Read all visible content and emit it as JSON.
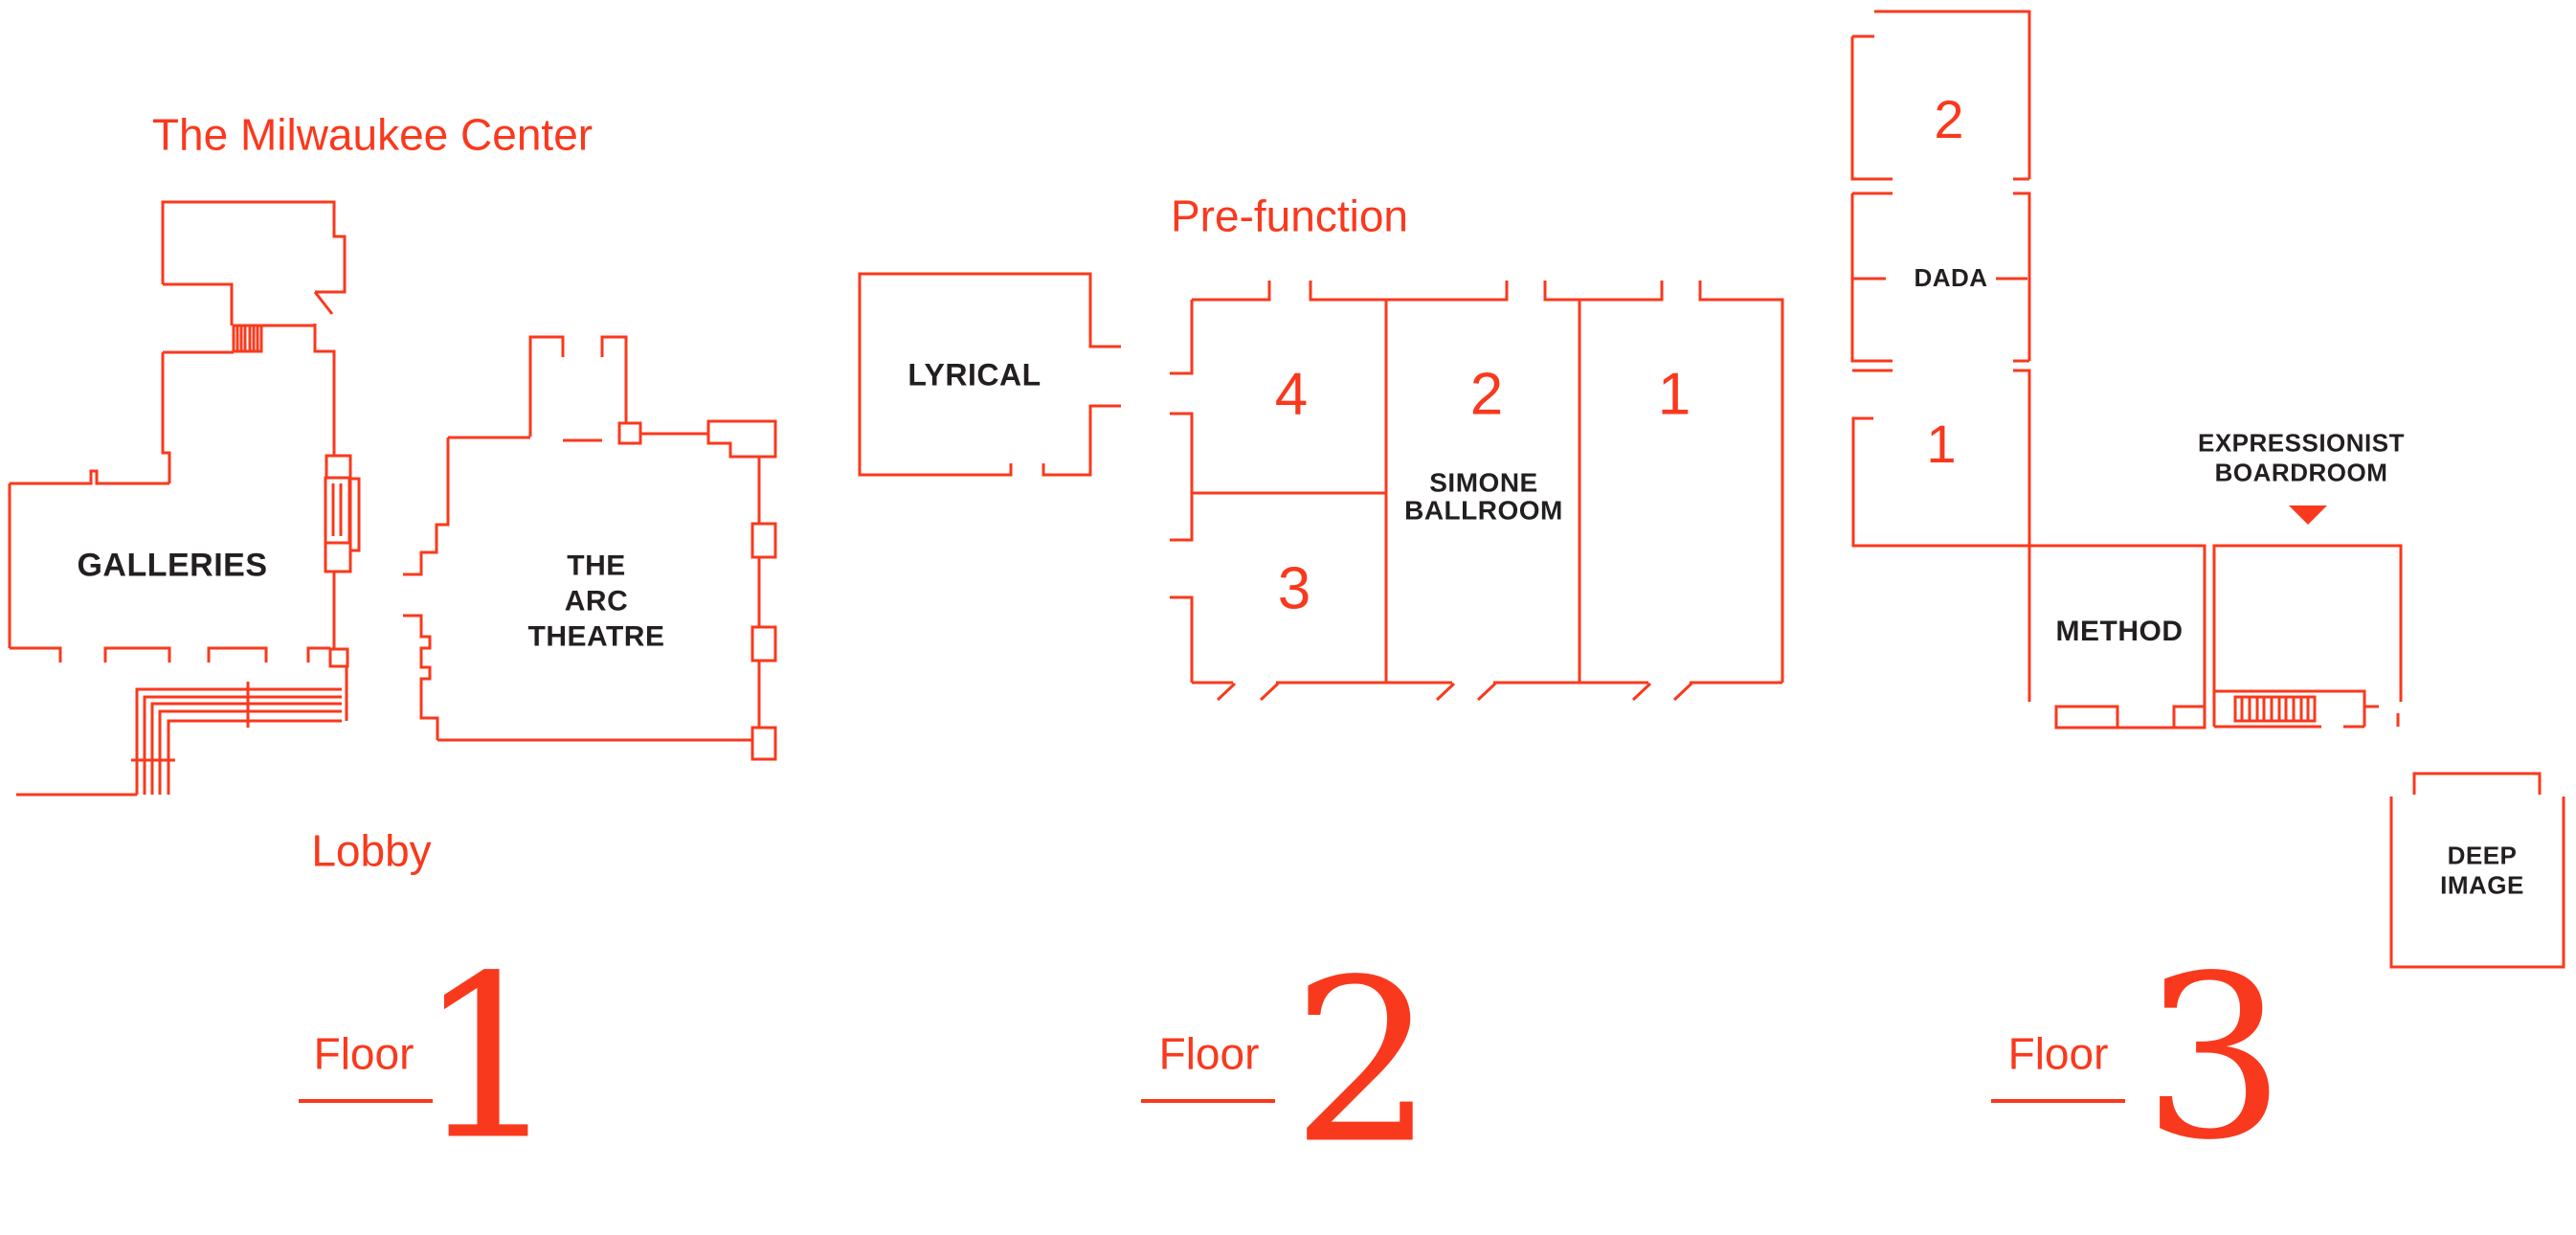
{
  "palette": {
    "line_red": "#f9391d",
    "text_red": "#f9391d",
    "text_black": "#231f20",
    "background": "#ffffff"
  },
  "floor1": {
    "building_title": "The Milwaukee Center",
    "galleries_label": "GALLERIES",
    "arc_theatre_line1": "THE",
    "arc_theatre_line2": "ARC",
    "arc_theatre_line3": "THEATRE",
    "lobby_label": "Lobby",
    "floor_word": "Floor",
    "floor_number": "1"
  },
  "floor2": {
    "prefunction_label": "Pre-function",
    "lyrical_label": "LYRICAL",
    "ballroom_section_4": "4",
    "ballroom_section_2": "2",
    "ballroom_section_1": "1",
    "ballroom_section_3": "3",
    "ballroom_name_line1": "SIMONE",
    "ballroom_name_line2": "BALLROOM",
    "floor_word": "Floor",
    "floor_number": "2"
  },
  "floor3": {
    "section_2": "2",
    "dada_label": "DADA",
    "section_1": "1",
    "method_label": "METHOD",
    "boardroom_line1": "EXPRESSIONIST",
    "boardroom_line2": "BOARDROOM",
    "deep_image_line1": "DEEP",
    "deep_image_line2": "IMAGE",
    "floor_word": "Floor",
    "floor_number": "3"
  }
}
